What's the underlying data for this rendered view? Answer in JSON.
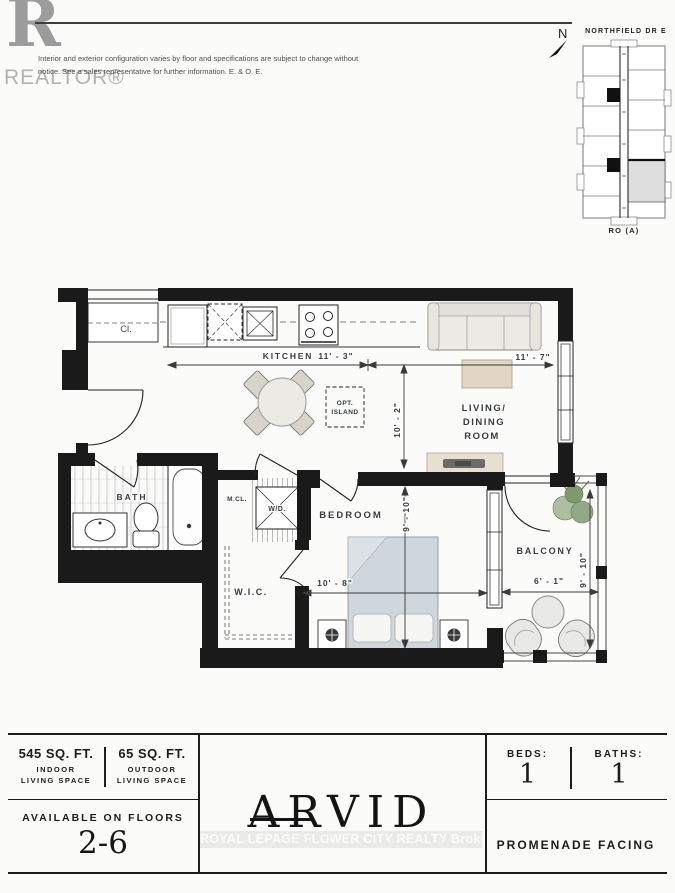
{
  "header": {
    "logo_letter": "R",
    "logo_text": "REALTOR®",
    "disclaimer_line1": "Interior and exterior configuration varies by floor and specifications are subject to change without",
    "disclaimer_line2": "notice. See a sales representative for further information. E. & O. E."
  },
  "keyplan": {
    "north": "N",
    "street": "NORTHFIELD DR E",
    "unit": "RO (A)"
  },
  "plan": {
    "labels": {
      "closet": "Cl.",
      "kitchen": "KITCHEN",
      "bath": "BATH",
      "mcl": "M.CL.",
      "wd": "W/D.",
      "wic": "W.I.C.",
      "bedroom": "BEDROOM",
      "living_line1": "LIVING/",
      "living_line2": "DINING",
      "living_line3": "ROOM",
      "balcony": "BALCONY",
      "island_line1": "OPT.",
      "island_line2": "ISLAND"
    },
    "dimensions": {
      "kitchen_width": "11' - 3\"",
      "living_width": "11' - 7\"",
      "living_depth": "10' - 2\"",
      "bedroom_depth": "9' - 10\"",
      "bedroom_width": "10' - 8\"",
      "balcony_width": "6' - 1\"",
      "balcony_depth": "9' - 10\""
    }
  },
  "footer": {
    "indoor_sqft": "545 SQ. FT.",
    "indoor_line1": "INDOOR",
    "indoor_line2": "LIVING SPACE",
    "outdoor_sqft": "65 SQ. FT.",
    "outdoor_line1": "OUTDOOR",
    "outdoor_line2": "LIVING SPACE",
    "floors_label": "AVAILABLE ON FLOORS",
    "floors_value": "2-6",
    "unit_name": "ARVID",
    "watermark": "ROYAL LEPAGE FLOWER CITY REALTY Brokerage",
    "beds_label": "BEDS:",
    "beds_value": "1",
    "baths_label": "BATHS:",
    "baths_value": "1",
    "facing": "PROMENADE FACING"
  },
  "colors": {
    "wall": "#1a1a1a",
    "furniture_beige": "#e5ddcd",
    "bed_blue": "#cfd6dc",
    "plant_green": "#93a886",
    "text_dark": "#343b3b",
    "logo_grey": "#9c9c9c"
  }
}
